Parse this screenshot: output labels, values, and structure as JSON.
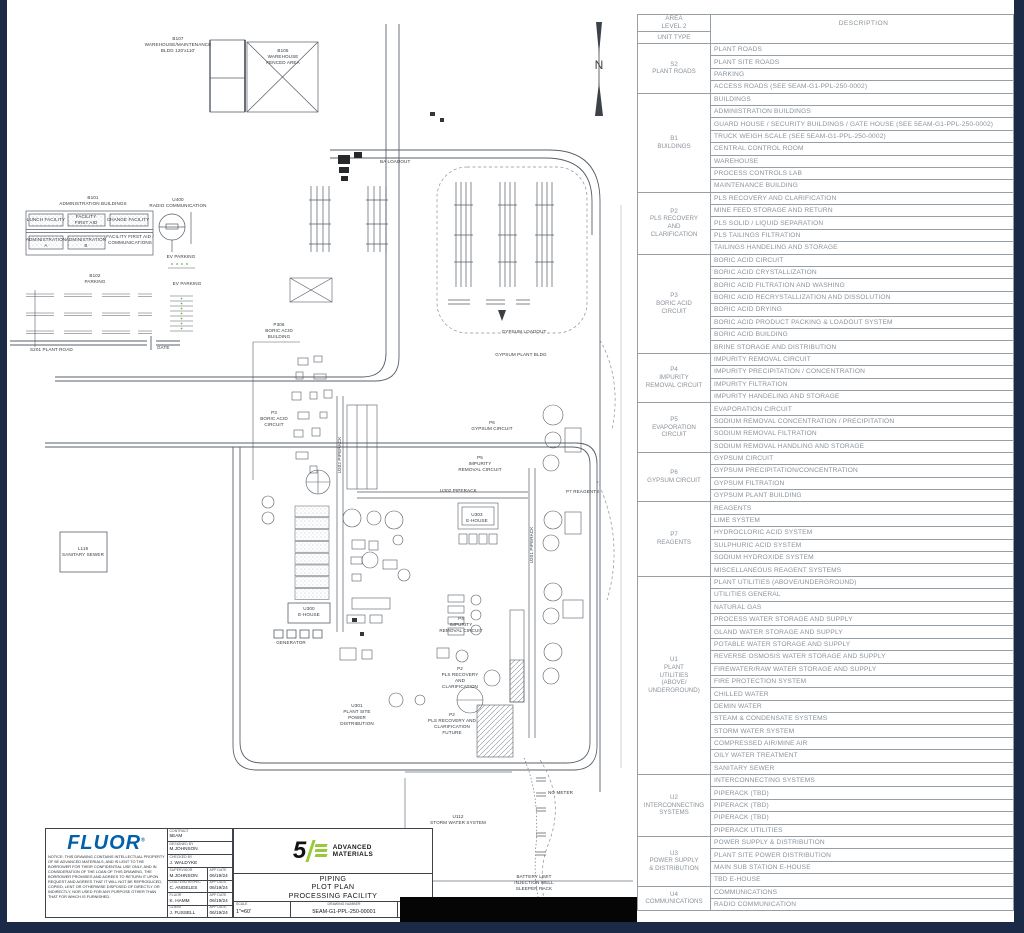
{
  "drawing": {
    "north_label": "N",
    "labels": [
      {
        "t": "B107\nWAREHOUSE/MAINTENANCE\nBLDG 120'x110'",
        "x": 178,
        "y": 36
      },
      {
        "t": "B105\nWAREHOUSE\nFENCED AREA",
        "x": 283,
        "y": 48
      },
      {
        "t": "B101\nADMINISTRATION BUILDINGS",
        "x": 93,
        "y": 195
      },
      {
        "t": "U400\nRADIO COMMUNICATION",
        "x": 178,
        "y": 197
      },
      {
        "t": "LUNCH FACILITY",
        "x": 46,
        "y": 217
      },
      {
        "t": "FACILITY\nFIRST AID",
        "x": 86,
        "y": 214
      },
      {
        "t": "CHANGE FACILITY",
        "x": 128,
        "y": 217
      },
      {
        "t": "ADMINISTRATION\nA",
        "x": 46,
        "y": 237
      },
      {
        "t": "ADMINISTRATION\nB",
        "x": 86,
        "y": 237
      },
      {
        "t": "FACILITY FIRST AID /\nCOMMUNICATIONS",
        "x": 130,
        "y": 234
      },
      {
        "t": "EV PARKING",
        "x": 181,
        "y": 254
      },
      {
        "t": "B102\nPARKING",
        "x": 95,
        "y": 273
      },
      {
        "t": "EV PARKING",
        "x": 187,
        "y": 281
      },
      {
        "t": "S201 PLANT ROAD",
        "x": 30,
        "y": 347,
        "cls": "l"
      },
      {
        "t": "GATE",
        "x": 157,
        "y": 345,
        "cls": "l"
      },
      {
        "t": "BA LOADOUT",
        "x": 380,
        "y": 159,
        "cls": "l"
      },
      {
        "t": "P306\nBORIC ACID\nBUILDING",
        "x": 279,
        "y": 322
      },
      {
        "t": "P3\nBORIC ACID\nCIRCUIT",
        "x": 274,
        "y": 410
      },
      {
        "t": "U202 PIPERACK",
        "x": 340,
        "y": 455,
        "cls": "v"
      },
      {
        "t": "U302 PIPERACK",
        "x": 440,
        "y": 488,
        "cls": "l"
      },
      {
        "t": "P6\nGYPSUM CIRCUIT",
        "x": 492,
        "y": 420
      },
      {
        "t": "P5\nIMPURITY\nREMOVAL CIRCUIT",
        "x": 480,
        "y": 455
      },
      {
        "t": "U303\nE-HOUSE",
        "x": 477,
        "y": 512
      },
      {
        "t": "P7 REAGENTS",
        "x": 566,
        "y": 489,
        "cls": "l"
      },
      {
        "t": "U201 PIPERACK",
        "x": 532,
        "y": 545,
        "cls": "v"
      },
      {
        "t": "U300\nE-HOUSE",
        "x": 309,
        "y": 606
      },
      {
        "t": "GENERATOR",
        "x": 291,
        "y": 640
      },
      {
        "t": "L119\nSANITARY SEWER",
        "x": 83,
        "y": 546
      },
      {
        "t": "U301\nPLANT SITE\nPOWER\nDISTRIBUTION",
        "x": 357,
        "y": 703
      },
      {
        "t": "P4\nIMPURITY\nREMOVAL CIRCUIT",
        "x": 461,
        "y": 616
      },
      {
        "t": "P2\nPLS RECOVERY\nAND\nCLARIFICATION",
        "x": 460,
        "y": 666
      },
      {
        "t": "P2\nPLS RECOVERY AND\nCLARIFICATION\nFUTURE",
        "x": 452,
        "y": 712
      },
      {
        "t": "GYPSUM LOADOUT",
        "x": 524,
        "y": 329
      },
      {
        "t": "GYPSUM PLANT BLDG",
        "x": 521,
        "y": 352
      },
      {
        "t": "U112\nSTORM WATER SYSTEM",
        "x": 458,
        "y": 814
      },
      {
        "t": "NO METER",
        "x": 548,
        "y": 790,
        "cls": "l"
      },
      {
        "t": "BATTERY LIMIT\nINJECTION WELL\nSLEEPER RACK",
        "x": 534,
        "y": 874
      },
      {
        "t": "N",
        "x": 599,
        "y": 58,
        "cls": "n"
      }
    ]
  },
  "table": {
    "header": {
      "area": "AREA\nLEVEL 2",
      "unit_type": "UNIT TYPE",
      "description": "DESCRIPTION"
    },
    "groups": [
      {
        "unit": "S2\nPLANT ROADS",
        "rows": [
          "PLANT ROADS",
          "PLANT SITE ROADS",
          "PARKING",
          "ACCESS ROADS (SEE 5EAM-G1-PPL-250-0002)"
        ]
      },
      {
        "unit": "B1\nBUILDINGS",
        "rows": [
          "BUILDINGS",
          "ADMINISTRATION BUILDINGS",
          "GUARD HOUSE / SECURITY BUILDINGS / GATE HOUSE (SEE 5EAM-G1-PPL-250-0002)",
          "TRUCK WEIGH SCALE (SEE 5EAM-G1-PPL-250-0002)",
          "CENTRAL CONTROL ROOM",
          "WAREHOUSE",
          "PROCESS CONTROLS LAB",
          "MAINTENANCE BUILDING"
        ]
      },
      {
        "unit": "P2\nPLS RECOVERY\nAND\nCLARIFICATION",
        "rows": [
          "PLS RECOVERY AND CLARIFICATION",
          "MINE FEED STORAGE AND RETURN",
          "PLS SOLID / LIQUID SEPARATION",
          "PLS TAILINGS FILTRATION",
          "TAILINGS HANDELING AND STORAGE"
        ]
      },
      {
        "unit": "P3\nBORIC ACID\nCIRCUIT",
        "rows": [
          "BORIC ACID CIRCUIT",
          "BORIC ACID CRYSTALLIZATION",
          "BORIC ACID FILTRATION AND WASHING",
          "BORIC ACID RECRYSTALLIZATION AND DISSOLUTION",
          "BORIC ACID DRYING",
          "BORIC ACID PRODUCT PACKING & LOADOUT SYSTEM",
          "BORIC ACID BUILDING",
          "BRINE STORAGE AND DISTRIBUTION"
        ]
      },
      {
        "unit": "P4\nIMPURITY\nREMOVAL CIRCUIT",
        "rows": [
          "IMPURITY REMOVAL CIRCUIT",
          "IMPURITY PRECIPITATION / CONCENTRATION",
          "IMPURITY FILTRATION",
          "IMPURITY HANDELING AND STORAGE"
        ]
      },
      {
        "unit": "P5\nEVAPORATION\nCIRCUIT",
        "rows": [
          "EVAPORATION CIRCUIT",
          "SODIUM REMOVAL CONCENTRATION / PRECIPITATION",
          "SODIUM REMOVAL FILTRATION",
          "SODIUM REMOVAL HANDLING AND STORAGE"
        ]
      },
      {
        "unit": "P6\nGYPSUM CIRCUIT",
        "rows": [
          "GYPSUM CIRCUIT",
          "GYPSUM PRECIPITATION/CONCENTRATION",
          "GYPSUM FILTRATION",
          "GYPSUM PLANT BUILDING"
        ]
      },
      {
        "unit": "P7\nREAGENTS",
        "rows": [
          "REAGENTS",
          "LIME SYSTEM",
          "HYDROCLORIC ACID SYSTEM",
          "SULPHURIC ACID SYSTEM",
          "SODIUM HYDROXIDE SYSTEM",
          "MISCELLANEOUS REAGENT SYSTEMS"
        ]
      },
      {
        "unit": "U1\nPLANT\nUTILITIES\n(ABOVE/\nUNDERGROUND)",
        "rows": [
          "PLANT UTILITIES (ABOVE/UNDERGROUND)",
          "UTILITIES GENERAL",
          "NATURAL GAS",
          "PROCESS WATER STORAGE AND SUPPLY",
          "GLAND WATER STORAGE AND SUPPLY",
          "POTABLE WATER STORAGE AND SUPPLY",
          "REVERSE OSMOSIS WATER STORAGE AND SUPPLY",
          "FIREWATER/RAW WATER STORAGE AND SUPPLY",
          "FIRE PROTECTION SYSTEM",
          "CHILLED WATER",
          "DEMIN WATER",
          "STEAM & CONDENSATE SYSTEMS",
          "STORM WATER SYSTEM",
          "COMPRESSED AIR/MINE AIR",
          "OILY WATER TREATMENT",
          "SANITARY SEWER"
        ]
      },
      {
        "unit": "U2\nINTERCONNECTING\nSYSTEMS",
        "rows": [
          "INTERCONNECTING SYSTEMS",
          "PIPERACK (TBD)",
          "PIPERACK (TBD)",
          "PIPERACK (TBD)",
          "PIPERACK UTILITIES"
        ]
      },
      {
        "unit": "U3\nPOWER SUPPLY\n& DISTRIBUTION",
        "rows": [
          "POWER SUPPLY & DISTRIBUTION",
          "PLANT SITE POWER DISTRIBUTION",
          "MAIN SUB STATION E-HOUSE",
          "TBD E-HOUSE"
        ]
      },
      {
        "unit": "U4\nCOMMUNICATIONS",
        "rows": [
          "COMMUNICATIONS",
          "RADIO COMMUNICATION"
        ]
      }
    ]
  },
  "title_block": {
    "brand": "FLUOR",
    "brand_reg": "®",
    "notice": "NOTICE: THIS DRAWING CONTAINS INTELLECTUAL PROPERTY OF 5E ADVANCED MATERIALS, AND IS LENT TO THE BORROWER FOR THEIR CONFIDENTIAL USE ONLY, AND IN CONSIDERATION OF THE LOAN OF THIS DRAWING, THE BORROWER PROMISES AND AGREES TO RETURN IT UPON REQUEST AND AGREES THAT IT WILL NOT BE REPRODUCED, COPIED, LENT OR OTHERWISE DISPOSED OF DIRECTLY OR INDIRECTLY, NOR USED FOR ANY PURPOSE OTHER THAN THAT FOR WHICH IS FURNISHED.",
    "contract_label": "CONTRACT",
    "contract": "5EAM",
    "designed_label": "DESIGNED BY",
    "designed": "M.JOHNSON",
    "checked_label": "CHECKED BY",
    "checked": "J. WALDYKE",
    "app_date_label": "APP DATE",
    "approvals": [
      {
        "role": "SUPERVISOR",
        "name": "M.JOHNSON",
        "date": "06/19/24"
      },
      {
        "role": "LEAD ENG'R/SPEC",
        "name": "C. ANGELES",
        "date": "06/19/24"
      },
      {
        "role": "FLUOR",
        "name": "K. HAMM",
        "date": "06/19/24"
      },
      {
        "role": "CLIENT",
        "name": "J. FUSSELL",
        "date": "06/19/24"
      }
    ],
    "partner_mark": "5",
    "partner_name_1": "ADVANCED",
    "partner_name_2": "MATERIALS",
    "title_1": "PIPING",
    "title_2": "PLOT PLAN",
    "title_3": "PROCESSING FACILITY",
    "scale_label": "SCALE",
    "scale": "1\"=60'",
    "dwg_label": "DRAWING NUMBER",
    "dwg_number": "5EAM-G1-PPL-250-00001",
    "rev_label": "REV",
    "rev": "F"
  },
  "colors": {
    "navy": "#1b2a47",
    "fluor_blue": "#0060a9",
    "logo_green": "#97c83d"
  }
}
